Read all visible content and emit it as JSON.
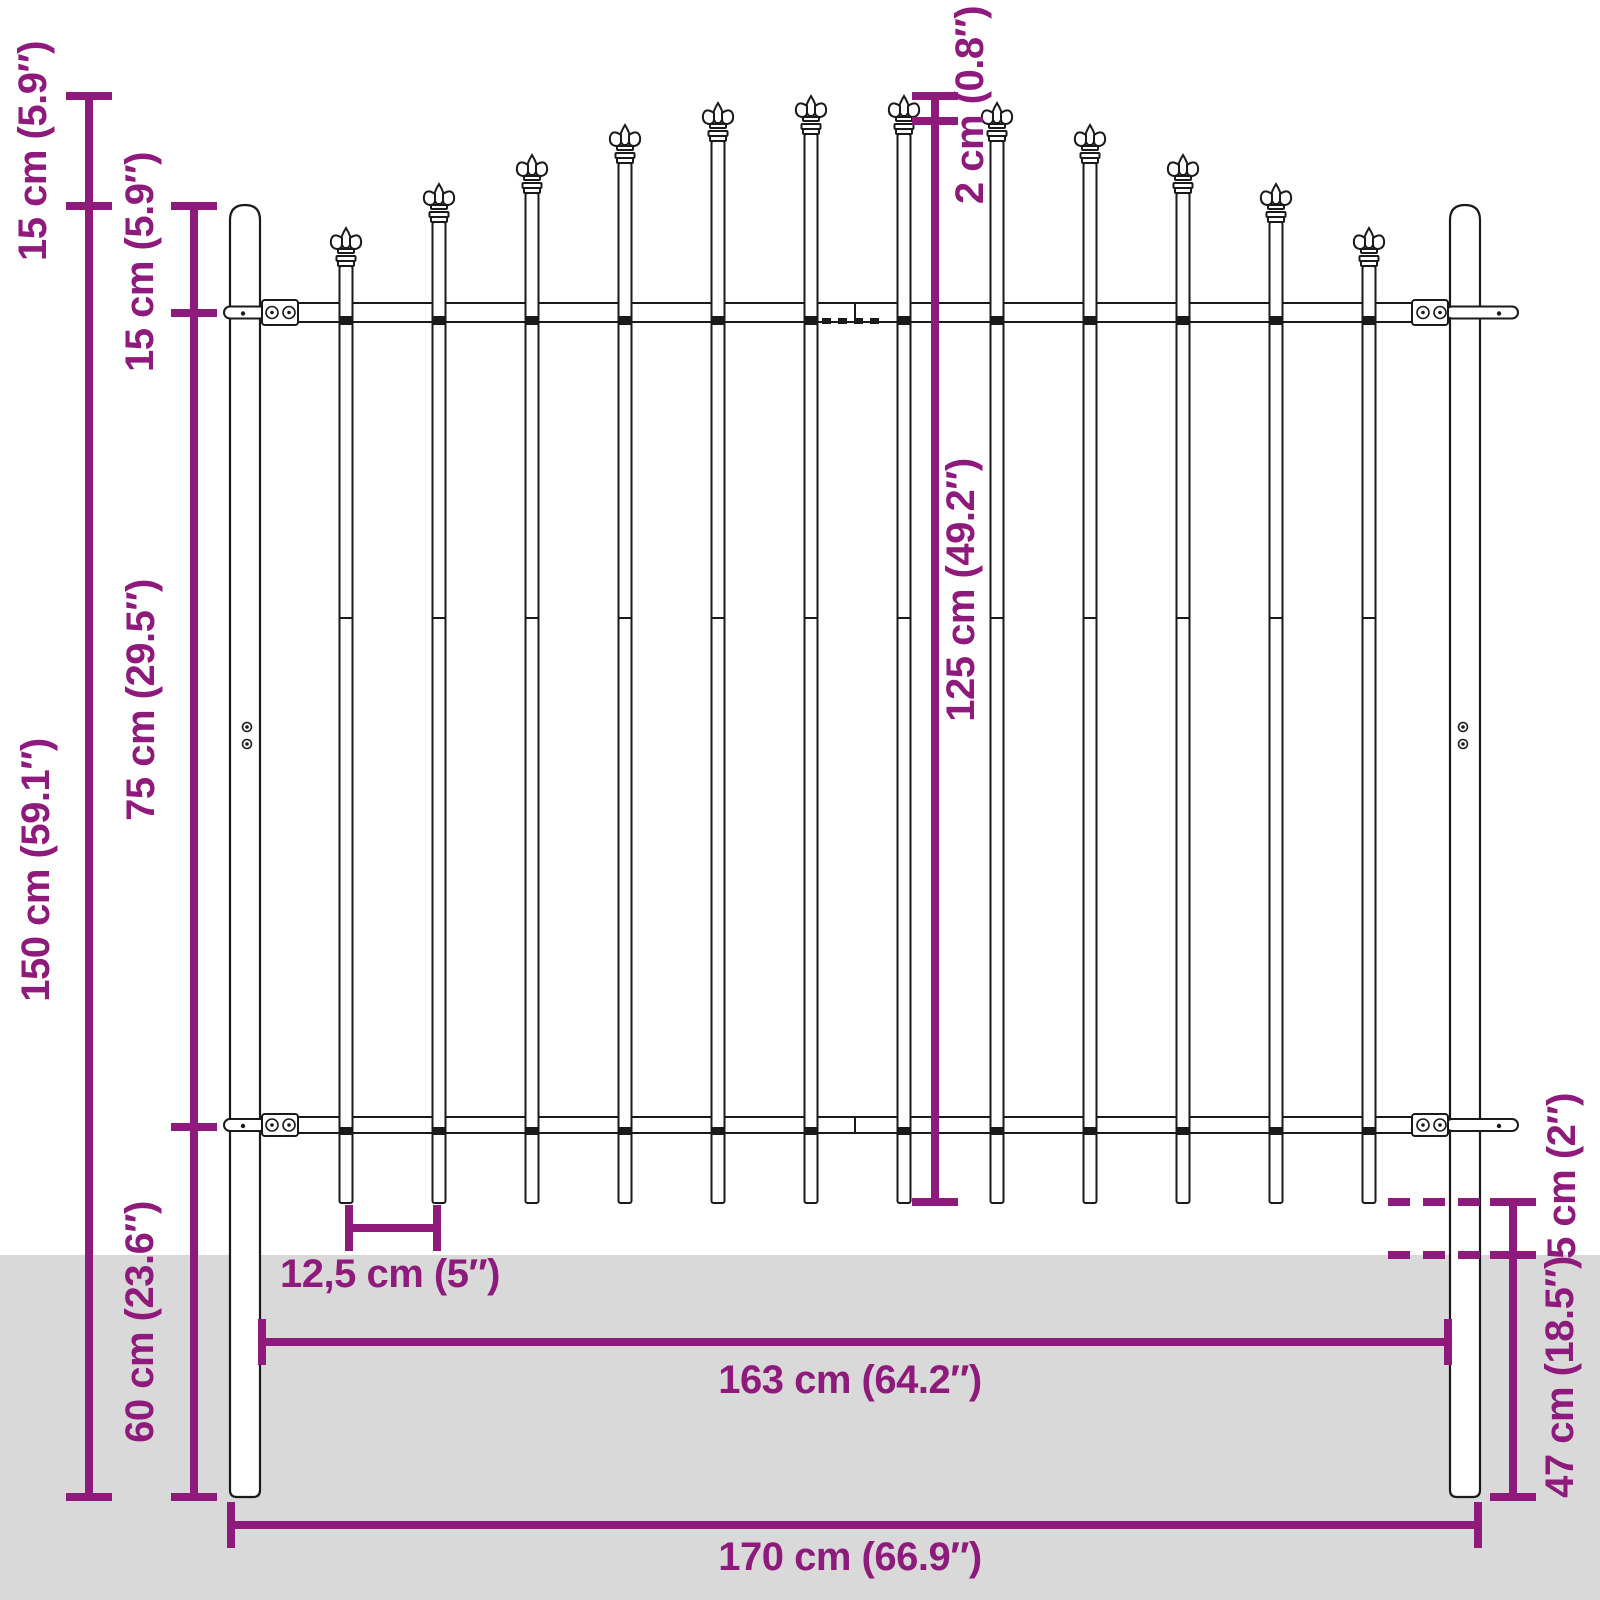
{
  "diagram": {
    "type": "technical-drawing",
    "subject": "garden-fence-panel-with-spear-top"
  },
  "colors": {
    "dimension": "#8e1b7c",
    "outline": "#1a1a1a",
    "fill": "#ffffff",
    "ground": "#d9d9d9",
    "background": "#ffffff"
  },
  "dimensions": [
    {
      "id": "spear-top-offset",
      "label": "15 cm (5.9″)"
    },
    {
      "id": "post-top-to-rail",
      "label": "15 cm (5.9″)"
    },
    {
      "id": "total-height",
      "label": "150 cm (59.1″)"
    },
    {
      "id": "rail-spacing",
      "label": "75 cm (29.5″)"
    },
    {
      "id": "underground-depth",
      "label": "60 cm (23.6″)"
    },
    {
      "id": "spear-step",
      "label": "2 cm (0.8″)"
    },
    {
      "id": "panel-height",
      "label": "125 cm (49.2″)"
    },
    {
      "id": "bar-ground-clearance",
      "label": "5 cm (2″)"
    },
    {
      "id": "post-underground",
      "label": "47 cm (18.5″)"
    },
    {
      "id": "bar-spacing",
      "label": "12,5 cm (5″)"
    },
    {
      "id": "panel-width",
      "label": "163 cm (64.2″)"
    },
    {
      "id": "total-width",
      "label": "170 cm (66.9″)"
    }
  ],
  "fence": {
    "ground_y": 1255,
    "posts": {
      "left_x": 230,
      "right_x": 1450,
      "width": 30,
      "top_y": 205,
      "bottom_y": 1497,
      "screw_ys": [
        727,
        744
      ]
    },
    "rails": {
      "x1": 260,
      "x2": 1450,
      "seam_x": 855,
      "top": {
        "y": 303,
        "h": 19
      },
      "bottom": {
        "y": 1117,
        "h": 16
      }
    },
    "bars": {
      "count": 12,
      "first_center_x": 346,
      "pitch": 93,
      "width": 13,
      "bottom_y": 1203,
      "joint_y": 618,
      "tip_ys": [
        228,
        184,
        155,
        125,
        103,
        96,
        96,
        103,
        125,
        155,
        184,
        228
      ]
    }
  },
  "dimension_lines": [
    {
      "id": "left-outer-height",
      "x1": 89,
      "y1": 96,
      "x2": 89,
      "y2": 1497,
      "dashed": false,
      "ticks": [
        {
          "x": 89,
          "y": 96,
          "d": "h"
        },
        {
          "x": 89,
          "y": 206,
          "d": "h"
        },
        {
          "x": 89,
          "y": 1497,
          "d": "h"
        }
      ]
    },
    {
      "id": "left-inner-height",
      "x1": 194,
      "y1": 206,
      "x2": 194,
      "y2": 1497,
      "dashed": false,
      "ticks": [
        {
          "x": 194,
          "y": 206,
          "d": "h"
        },
        {
          "x": 194,
          "y": 313,
          "d": "h"
        },
        {
          "x": 194,
          "y": 1127,
          "d": "h"
        },
        {
          "x": 194,
          "y": 1497,
          "d": "h"
        }
      ]
    },
    {
      "id": "center-height",
      "x1": 935,
      "y1": 96,
      "x2": 935,
      "y2": 1202,
      "dashed": false,
      "ticks": [
        {
          "x": 935,
          "y": 96,
          "d": "h"
        },
        {
          "x": 935,
          "y": 121,
          "d": "h"
        },
        {
          "x": 935,
          "y": 1202,
          "d": "h"
        }
      ]
    },
    {
      "id": "bar-spacing",
      "x1": 349,
      "y1": 1228,
      "x2": 437,
      "y2": 1228,
      "dashed": false,
      "ticks": [
        {
          "x": 349,
          "y": 1228,
          "d": "v"
        },
        {
          "x": 437,
          "y": 1228,
          "d": "v"
        }
      ]
    },
    {
      "id": "panel-width",
      "x1": 262,
      "y1": 1342,
      "x2": 1448,
      "y2": 1342,
      "dashed": false,
      "ticks": [
        {
          "x": 262,
          "y": 1342,
          "d": "v"
        },
        {
          "x": 1448,
          "y": 1342,
          "d": "v"
        }
      ]
    },
    {
      "id": "total-width",
      "x1": 231,
      "y1": 1525,
      "x2": 1478,
      "y2": 1525,
      "dashed": false,
      "ticks": [
        {
          "x": 231,
          "y": 1525,
          "d": "v"
        },
        {
          "x": 1478,
          "y": 1525,
          "d": "v"
        }
      ]
    },
    {
      "id": "right-depth",
      "x1": 1513,
      "y1": 1202,
      "x2": 1513,
      "y2": 1497,
      "dashed": false,
      "ticks": [
        {
          "x": 1513,
          "y": 1202,
          "d": "h"
        },
        {
          "x": 1513,
          "y": 1255,
          "d": "h"
        },
        {
          "x": 1513,
          "y": 1497,
          "d": "h"
        }
      ]
    },
    {
      "id": "bar-bottom-level",
      "x1": 1388,
      "y1": 1202,
      "x2": 1497,
      "y2": 1202,
      "dashed": true,
      "ticks": []
    },
    {
      "id": "ground-level",
      "x1": 1388,
      "y1": 1255,
      "x2": 1497,
      "y2": 1255,
      "dashed": true,
      "ticks": []
    }
  ]
}
